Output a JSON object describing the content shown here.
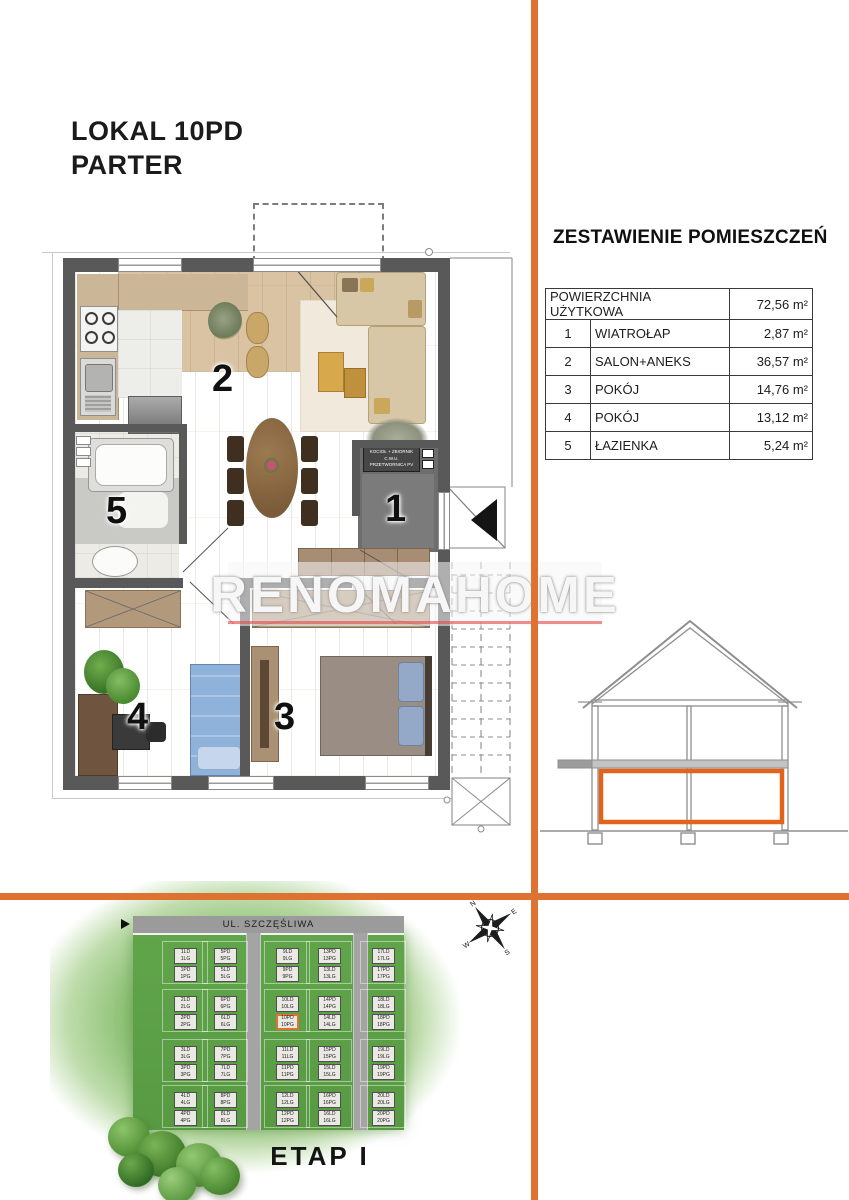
{
  "header": {
    "line1": "LOKAL 10PD",
    "line2": "PARTER"
  },
  "summary": {
    "title": "ZESTAWIENIE POMIESZCZEŃ",
    "total_label": "POWIERZCHNIA UŻYTKOWA",
    "total_area": "72,56 m²",
    "rows": [
      {
        "no": "1",
        "name": "WIATROŁAP",
        "area": "2,87 m²"
      },
      {
        "no": "2",
        "name": "SALON+ANEKS",
        "area": "36,57 m²"
      },
      {
        "no": "3",
        "name": "POKÓJ",
        "area": "14,76 m²"
      },
      {
        "no": "4",
        "name": "POKÓJ",
        "area": "13,12 m²"
      },
      {
        "no": "5",
        "name": "ŁAZIENKA",
        "area": "5,24 m²"
      }
    ]
  },
  "floor_plan": {
    "room1": "1",
    "room2": "2",
    "room3": "3",
    "room4": "4",
    "room5": "5",
    "boiler_line1": "KOCIOŁ + ZBIORNIK C.W.U.",
    "boiler_line2": "PRZETWORNICA PV"
  },
  "watermark": {
    "text": "RENOMAHOME"
  },
  "section": {
    "highlight_color": "#e2631c"
  },
  "divider_color": "#de7231",
  "site_plan": {
    "street": "UL. SZCZĘŚLIWA",
    "stage": "ETAP I",
    "highlighted_unit": "10PD / 10PG",
    "blocks": [
      {
        "top": [
          "1LD",
          "1LG"
        ],
        "bottom": [
          "1PD",
          "1PG"
        ],
        "col": 0,
        "row": 0
      },
      {
        "top": [
          "2LD",
          "2LG"
        ],
        "bottom": [
          "2PD",
          "2PG"
        ],
        "col": 0,
        "row": 1
      },
      {
        "top": [
          "3LD",
          "3LG"
        ],
        "bottom": [
          "3PD",
          "3PG"
        ],
        "col": 0,
        "row": 2
      },
      {
        "top": [
          "4LD",
          "4LG"
        ],
        "bottom": [
          "4PD",
          "4PG"
        ],
        "col": 0,
        "row": 3
      },
      {
        "top": [
          "5PD",
          "5PG"
        ],
        "bottom": [
          "5LD",
          "5LG"
        ],
        "col": 1,
        "row": 0
      },
      {
        "top": [
          "6PD",
          "6PG"
        ],
        "bottom": [
          "6LD",
          "6LG"
        ],
        "col": 1,
        "row": 1
      },
      {
        "top": [
          "7PD",
          "7PG"
        ],
        "bottom": [
          "7LD",
          "7LG"
        ],
        "col": 1,
        "row": 2
      },
      {
        "top": [
          "8PD",
          "8PG"
        ],
        "bottom": [
          "8LD",
          "8LG"
        ],
        "col": 1,
        "row": 3
      },
      {
        "top": [
          "9LD",
          "9LG"
        ],
        "bottom": [
          "9PD",
          "9PG"
        ],
        "col": 2,
        "row": 0
      },
      {
        "top": [
          "10LD",
          "10LG"
        ],
        "bottom": [
          "10PD",
          "10PG"
        ],
        "col": 2,
        "row": 1,
        "highlight": "bottom"
      },
      {
        "top": [
          "11LD",
          "11LG"
        ],
        "bottom": [
          "11PD",
          "11PG"
        ],
        "col": 2,
        "row": 2
      },
      {
        "top": [
          "12LD",
          "12LG"
        ],
        "bottom": [
          "12PD",
          "12PG"
        ],
        "col": 2,
        "row": 3
      },
      {
        "top": [
          "13PD",
          "13PG"
        ],
        "bottom": [
          "13LD",
          "13LG"
        ],
        "col": 3,
        "row": 0
      },
      {
        "top": [
          "14PD",
          "14PG"
        ],
        "bottom": [
          "14LD",
          "14LG"
        ],
        "col": 3,
        "row": 1
      },
      {
        "top": [
          "15PD",
          "15PG"
        ],
        "bottom": [
          "15LD",
          "15LG"
        ],
        "col": 3,
        "row": 2
      },
      {
        "top": [
          "16PD",
          "16PG"
        ],
        "bottom": [
          "16LD",
          "16LG"
        ],
        "col": 3,
        "row": 3
      },
      {
        "top": [
          "17LD",
          "17LG"
        ],
        "bottom": [
          "17PD",
          "17PG"
        ],
        "col": 4,
        "row": 0
      },
      {
        "top": [
          "18LD",
          "18LG"
        ],
        "bottom": [
          "18PD",
          "18PG"
        ],
        "col": 4,
        "row": 1
      },
      {
        "top": [
          "19LD",
          "19LG"
        ],
        "bottom": [
          "19PD",
          "19PG"
        ],
        "col": 4,
        "row": 2
      },
      {
        "top": [
          "20LD",
          "20LG"
        ],
        "bottom": [
          "20PD",
          "20PG"
        ],
        "col": 4,
        "row": 3
      }
    ]
  },
  "compass": {
    "n": "N",
    "e": "E",
    "s": "S",
    "w": "W"
  }
}
